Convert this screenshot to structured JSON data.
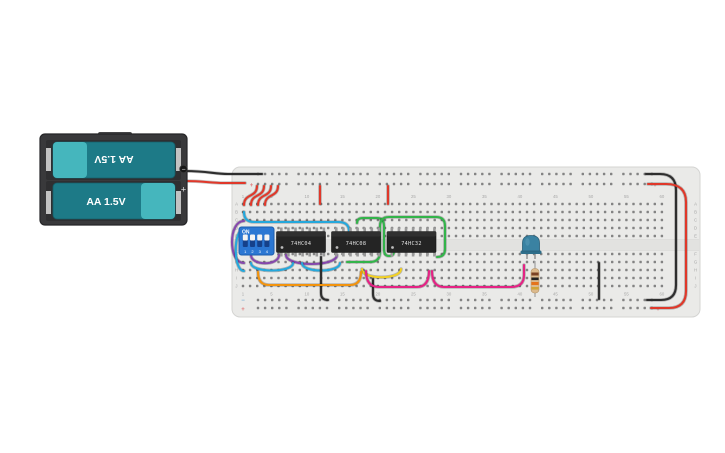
{
  "canvas": {
    "width": 725,
    "height": 453,
    "background": "#ffffff"
  },
  "battery": {
    "label_top": "AA 1.5V",
    "label_bottom": "AA 1.5V",
    "minus": "−",
    "plus": "+",
    "holder_color": "#39393b",
    "cell_color": "#1d7a87",
    "cell_light_color": "#45b6bd",
    "contact_color": "#c2c2c2"
  },
  "breadboard": {
    "base_color": "#eaeae8",
    "border_color": "#d4d4d2",
    "hole_color": "#838383",
    "label_color": "#a8a8a8",
    "rail_minus_symbol": "−",
    "rail_plus_symbol": "+",
    "rail_minus_color": "#7ab0d4",
    "rail_plus_color": "#e07a7a",
    "row_letters_top": [
      "A",
      "B",
      "C",
      "D",
      "E"
    ],
    "row_letters_bottom": [
      "F",
      "G",
      "H",
      "I",
      "J"
    ],
    "col_numbers": [
      1,
      5,
      10,
      15,
      20,
      25,
      30,
      35,
      40,
      45,
      50,
      55,
      60
    ]
  },
  "dip_switch": {
    "label": "ON",
    "positions": [
      "1",
      "2",
      "3",
      "4"
    ],
    "body_color": "#2b77d3",
    "track_color": "#15418a",
    "knob_color": "#f4f4f4"
  },
  "ics": [
    {
      "label": "74HC04"
    },
    {
      "label": "74HC08"
    },
    {
      "label": "74HC32"
    }
  ],
  "led": {
    "color": "#3a82a2",
    "flange_color": "#2e6e8a",
    "outline": "#2a5f78"
  },
  "resistor": {
    "body_color": "#dcba8d",
    "lead_color": "#ababab",
    "bands": [
      "#7a4224",
      "#222222",
      "#e5731b",
      "#d1a536"
    ]
  },
  "wires": [
    {
      "name": "wire-rail-bridge-negative",
      "color": "#2e2e2e",
      "d": "M646,174 L660,174 Q676,174 676,190 L676,285 Q676,300 661,300 L647,300"
    },
    {
      "name": "wire-rail-bridge-positive",
      "color": "#e0382a",
      "d": "M648,184 L666,184 Q686,184 686,202 L686,291 Q686,308 669,308 L651,308"
    },
    {
      "name": "wire-power-hook-1",
      "color": "#e0382a",
      "d": "M257,186 C257,198 244,193 244,205"
    },
    {
      "name": "wire-power-hook-2",
      "color": "#e0382a",
      "d": "M264,186 C264,198 251,193 251,205"
    },
    {
      "name": "wire-power-hook-3",
      "color": "#e0382a",
      "d": "M271,186 C271,198 258,193 258,205"
    },
    {
      "name": "wire-power-hook-4",
      "color": "#e0382a",
      "d": "M278,186 C278,198 265,193 265,205"
    },
    {
      "name": "wire-vcc-1",
      "color": "#e0382a",
      "d": "M320,186 L320,204"
    },
    {
      "name": "wire-vcc-2",
      "color": "#e0382a",
      "d": "M388,186 L388,204"
    },
    {
      "name": "wire-purple-wrap",
      "color": "#8648ad",
      "d": "M244,221 C228,221 228,263 244,263"
    },
    {
      "name": "wire-purple-jumper-1",
      "color": "#8648ad",
      "d": "M251,255 C251,266 279,266 279,255"
    },
    {
      "name": "wire-purple-jumper-2",
      "color": "#8648ad",
      "d": "M286,255 C286,267 337,267 337,255"
    },
    {
      "name": "wire-cyan-wrap",
      "color": "#25a8dc",
      "d": "M244,229 C233,229 233,271 244,271"
    },
    {
      "name": "wire-cyan-top",
      "color": "#25a8dc",
      "d": "M244,212 Q244,222 254,222 L338,222 Q349,222 349,231 L349,236"
    },
    {
      "name": "wire-cyan-jumper-1",
      "color": "#25a8dc",
      "d": "M251,263 C251,273 293,273 293,263"
    },
    {
      "name": "wire-cyan-jumper-2",
      "color": "#25a8dc",
      "d": "M302,263 C302,273 340,273 340,263"
    },
    {
      "name": "wire-green-1",
      "color": "#33b44a",
      "d": "M357,223 Q357,218 363,218 L377,218 Q384,218 384,226 L384,249 Q384,256 389,256 Q394,256 394,251"
    },
    {
      "name": "wire-green-2",
      "color": "#33b44a",
      "d": "M347,262 L370,262 Q380,262 380,252 L380,226 Q380,217 389,217 L436,217 Q445,217 445,226 L445,249 Q445,257 437,257"
    },
    {
      "name": "wire-yellow-jumper",
      "color": "#f2d022",
      "d": "M362,269 C362,280 401,280 401,269"
    },
    {
      "name": "wire-ground-1",
      "color": "#2e2e2e",
      "d": "M321,257 L321,293 Q321,300 328,300"
    },
    {
      "name": "wire-ground-2",
      "color": "#2e2e2e",
      "d": "M373,279 L373,294 Q373,301 380,301"
    },
    {
      "name": "wire-ground-3",
      "color": "#2e2e2e",
      "d": "M599,263 L599,299"
    },
    {
      "name": "wire-orange-jumper",
      "color": "#f2930d",
      "d": "M258,272 Q258,285 269,285 L350,285 Q361,285 361,272"
    },
    {
      "name": "wire-magenta-1",
      "color": "#e52284",
      "d": "M366,271 Q366,287 379,287 L417,287 Q429,287 429,271"
    },
    {
      "name": "wire-magenta-2",
      "color": "#e52284",
      "d": "M432,271 Q432,287 444,287 L511,287 Q524,287 524,275 L524,265"
    },
    {
      "name": "wire-battery-negative-lead",
      "color": "#2e2e2e",
      "d": "M185,171 C208,171 214,174 228,174 L262,174"
    },
    {
      "name": "wire-battery-positive-lead",
      "color": "#e0382a",
      "d": "M185,181 C204,181 210,183 224,183 L245,183"
    }
  ],
  "grid": {
    "col1_x": 243,
    "col_step": 7.1,
    "cols": 60,
    "rows_top_y": [
      204,
      212,
      220,
      228,
      236
    ],
    "rows_bottom_y": [
      254,
      262,
      270,
      278,
      286
    ],
    "rail_rows_y": [
      174,
      184,
      300,
      308
    ],
    "rail_start_x": 258,
    "rail_group_step": 40.6,
    "rail_groups": 10,
    "top_number_y": 198,
    "bottom_number_y": 295.5,
    "letter_left_x": 236.5,
    "letter_right_x": 695.5
  }
}
